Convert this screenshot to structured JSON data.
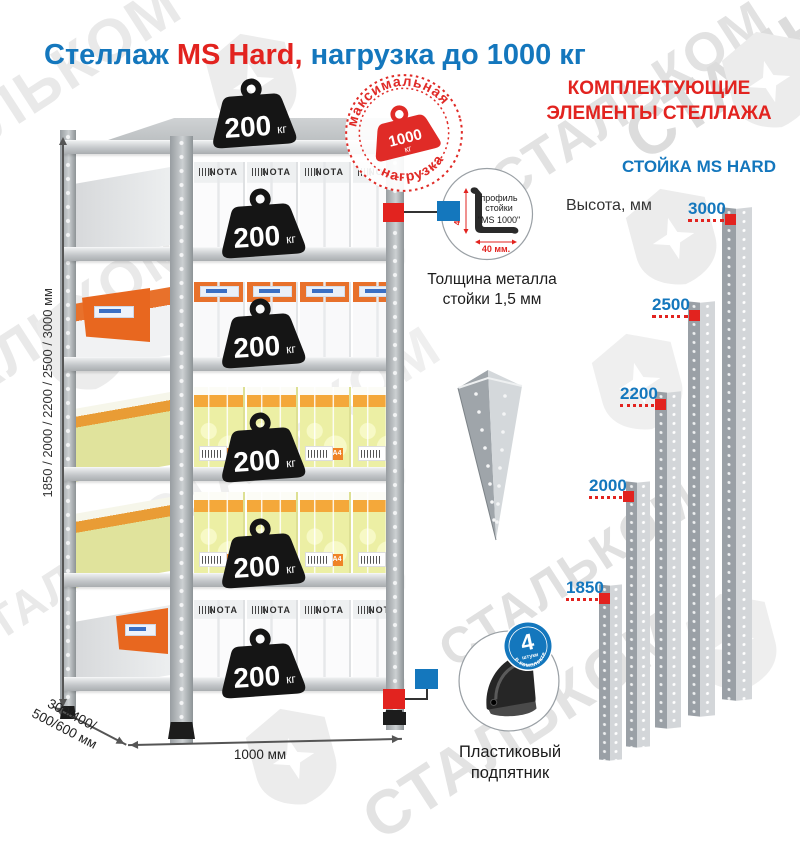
{
  "title": {
    "part1": "Стеллаж ",
    "part2": "MS Hard,",
    "part3": " нагрузка до 1000 кг"
  },
  "watermark": {
    "text": "СТАЛЬКОМ"
  },
  "stamp": {
    "arc_top": "максимальная",
    "arc_bottom": "нагрузка",
    "weight_value": "1000",
    "weight_unit": "кг"
  },
  "shelf": {
    "weight_value": "200",
    "weight_unit": "кг",
    "brand": "NOTA",
    "paper_label": "A4",
    "dim_height": "1850 / 2000 / 2200 / 2500 / 3000 мм",
    "dim_depth_line1": "300/400/",
    "dim_depth_line2": "500/600 мм",
    "dim_width": "1000 мм"
  },
  "profile": {
    "circle_line1": "профиль",
    "circle_line2": "стойки",
    "circle_line3": "\"MS 1000\"",
    "dim_vertical": "40 мм",
    "dim_horizontal": "40 мм.",
    "caption_line1": "Толщина металла",
    "caption_line2": "стойки 1,5 мм"
  },
  "foot": {
    "badge_number": "4",
    "badge_word": "штуки",
    "badge_arc": "в комплекте",
    "caption_line1": "Пластиковый",
    "caption_line2": "подпятник"
  },
  "right_panel": {
    "heading_line1": "КОМПЛЕКТУЮЩИЕ",
    "heading_line2": "ЭЛЕМЕНТЫ СТЕЛЛАЖА",
    "subheading": "СТОЙКА MS HARD",
    "height_label": "Высота, мм",
    "stands": [
      {
        "label": "3000"
      },
      {
        "label": "2500"
      },
      {
        "label": "2200"
      },
      {
        "label": "2000"
      },
      {
        "label": "1850"
      }
    ]
  },
  "colors": {
    "blue": "#1477bd",
    "red": "#e2231f",
    "stamp_red": "#e02b27",
    "metal_light": "#d3d6d9",
    "metal_dark": "#9aa0a6"
  }
}
